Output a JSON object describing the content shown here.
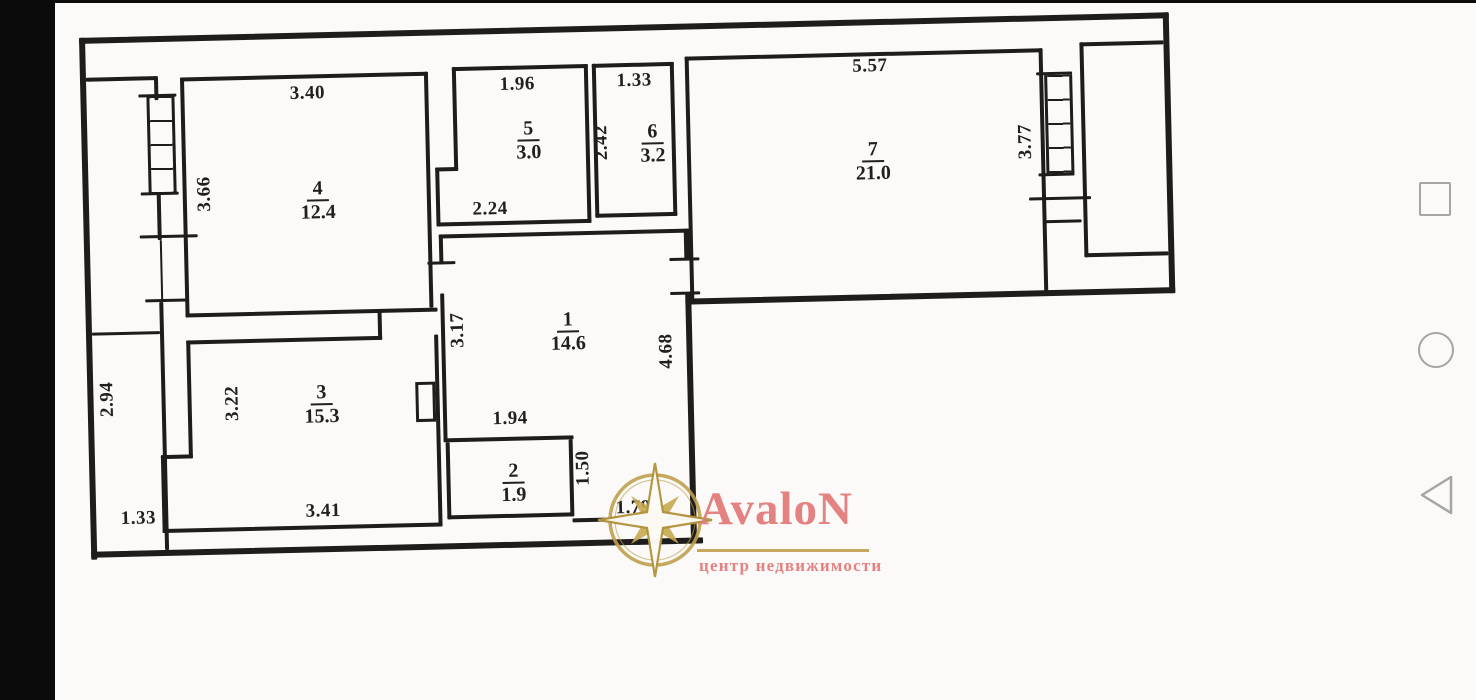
{
  "plan": {
    "title": "apartment floor plan",
    "rooms": {
      "r1": {
        "num": "1",
        "area": "14.6"
      },
      "r2": {
        "num": "2",
        "area": "1.9"
      },
      "r3": {
        "num": "3",
        "area": "15.3"
      },
      "r4": {
        "num": "4",
        "area": "12.4"
      },
      "r5": {
        "num": "5",
        "area": "3.0"
      },
      "r6": {
        "num": "6",
        "area": "3.2"
      },
      "r7": {
        "num": "7",
        "area": "21.0"
      }
    },
    "dims": [
      {
        "text": "3.40"
      },
      {
        "text": "3.66"
      },
      {
        "text": "1.96"
      },
      {
        "text": "2.24"
      },
      {
        "text": "1.33"
      },
      {
        "text": "2.42"
      },
      {
        "text": "5.57"
      },
      {
        "text": "3.77"
      },
      {
        "text": "3.17"
      },
      {
        "text": "4.68"
      },
      {
        "text": "1.94"
      },
      {
        "text": "1.50"
      },
      {
        "text": "1.79"
      },
      {
        "text": "3.22"
      },
      {
        "text": "3.41"
      },
      {
        "text": "2.94"
      },
      {
        "text": "1.33"
      }
    ]
  },
  "watermark": {
    "brand": "AvaloN",
    "tagline": "центр недвижимости",
    "brand_color": "#e37b7a",
    "gold_color": "#bfa04e"
  },
  "nav": {
    "recents_icon": "square",
    "home_icon": "circle",
    "back_icon": "triangle-left",
    "icon_color": "#a5a5a5"
  },
  "colors": {
    "wall": "#1e1d1b",
    "paper": "#fbfaf9",
    "letterbox": "#0b0b0b"
  }
}
